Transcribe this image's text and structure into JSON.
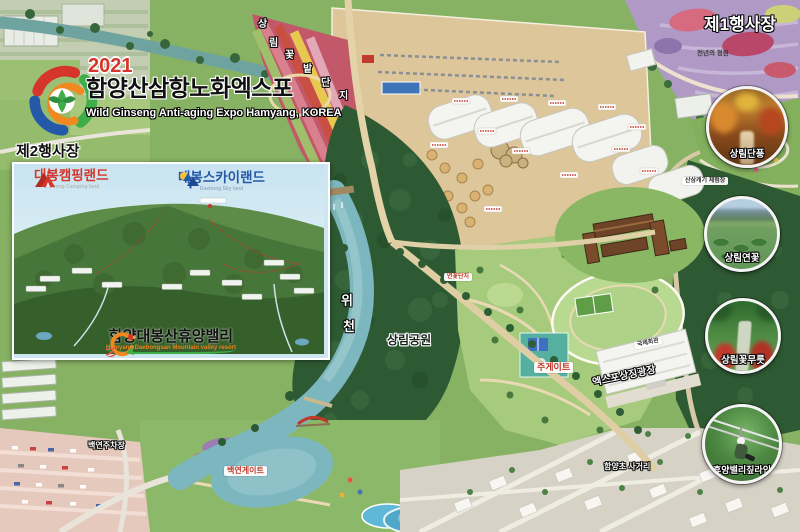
{
  "logo": {
    "year": "2021",
    "title": "함양산삼항노화엑스포",
    "subtitle": "Wild Ginseng Anti-aging Expo Hamyang, KOREA"
  },
  "venue1_label": "제1행사장",
  "venue2_label": "제2행사장",
  "inset": {
    "camping_name": "대봉캠핑랜드",
    "camping_subtitle": "Daebong Camping land",
    "sky_name": "대봉스카이랜드",
    "sky_subtitle": "Daebong Sky land",
    "resort_name": "함양대봉산휴양밸리",
    "resort_subtitle": "Hamyang Daebongsan Mountain valley resort"
  },
  "photo_circles": [
    {
      "label": "상림단풍"
    },
    {
      "label": "상림연꽃"
    },
    {
      "label": "상림꽃무릇"
    },
    {
      "label": "휴양밸리짚라인"
    }
  ],
  "map_labels": {
    "river_char_1": "위",
    "river_char_2": "천",
    "park": "상림공원",
    "main_gate": "주게이트",
    "baekyeon_gate": "백연게이트",
    "baekyeon_parking": "백연주차장",
    "hamyang_intersection": "함양초 사거리",
    "ginseng_experience": "산삼캐기 체험장",
    "millennium_garden": "천년의 정원",
    "expo_plaza": "엑스포상징광장",
    "intl_hall": "국제회관",
    "lotus_area": "연꽃단지",
    "flower_chars": [
      "상",
      "림",
      "꽃",
      "밭",
      "단",
      "지"
    ]
  },
  "colors": {
    "camping_red": "#d6352b",
    "sky_blue": "#2458a8",
    "resort_orange": "#f08a20",
    "river_teal": "#7cb6be",
    "forest_dark": "#2e5a33",
    "expo_ground_tan": "#ddc699",
    "lavender_purple": "#b09ac5"
  }
}
